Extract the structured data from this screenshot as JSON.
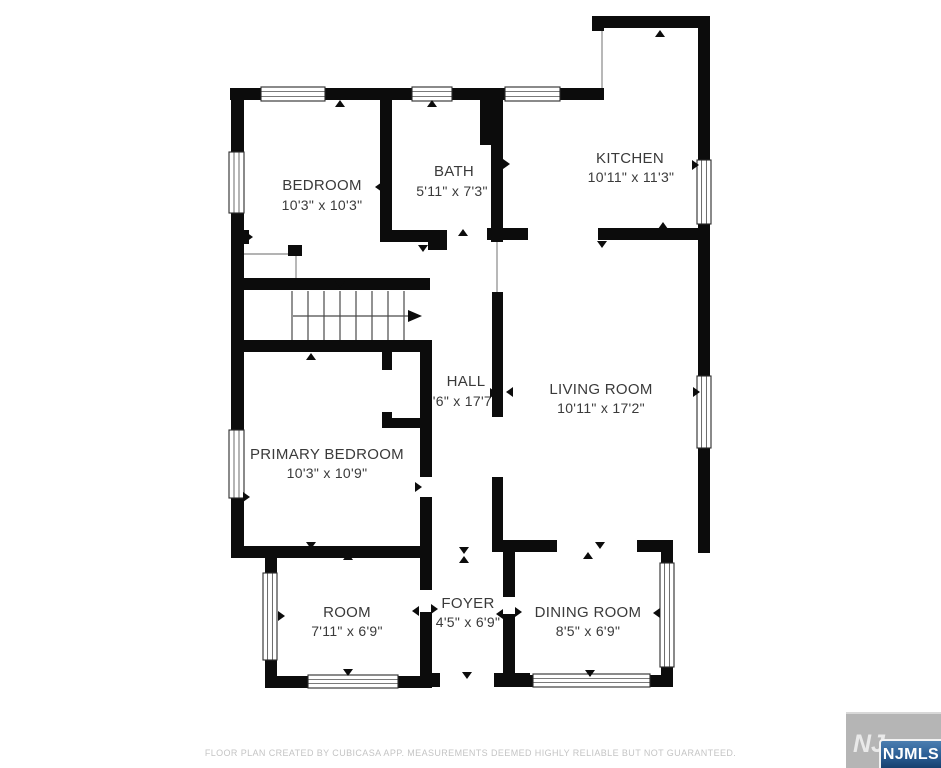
{
  "rooms": [
    {
      "id": "bedroom",
      "name": "BEDROOM",
      "dims": "10'3\" x 10'3\""
    },
    {
      "id": "bath",
      "name": "BATH",
      "dims": "5'11\" x 7'3\""
    },
    {
      "id": "kitchen",
      "name": "KITCHEN",
      "dims": "10'11\" x 11'3\""
    },
    {
      "id": "hall",
      "name": "HALL",
      "dims": "3'6\" x 17'7\""
    },
    {
      "id": "living-room",
      "name": "LIVING ROOM",
      "dims": "10'11\" x 17'2\""
    },
    {
      "id": "primary-bedroom",
      "name": "PRIMARY BEDROOM",
      "dims": "10'3\" x 10'9\""
    },
    {
      "id": "room",
      "name": "ROOM",
      "dims": "7'11\" x 6'9\""
    },
    {
      "id": "foyer",
      "name": "FOYER",
      "dims": "4'5\" x 6'9\""
    },
    {
      "id": "dining-room",
      "name": "DINING ROOM",
      "dims": "8'5\" x 6'9\""
    }
  ],
  "footer": {
    "disclaimer": "FLOOR PLAN CREATED BY CUBICASA APP. MEASUREMENTS DEEMED HIGHLY RELIABLE BUT NOT GUARANTEED."
  },
  "logo": {
    "watermark_text": "NJ",
    "text": "NJMLS"
  },
  "colors": {
    "wall": "#0c0c0c",
    "label": "#3a3a3a",
    "footer_text": "#c4c4c4",
    "logo_gray": "#b5b5b5",
    "logo_blue_top": "#4b7eb0",
    "logo_blue_bottom": "#16406e"
  }
}
